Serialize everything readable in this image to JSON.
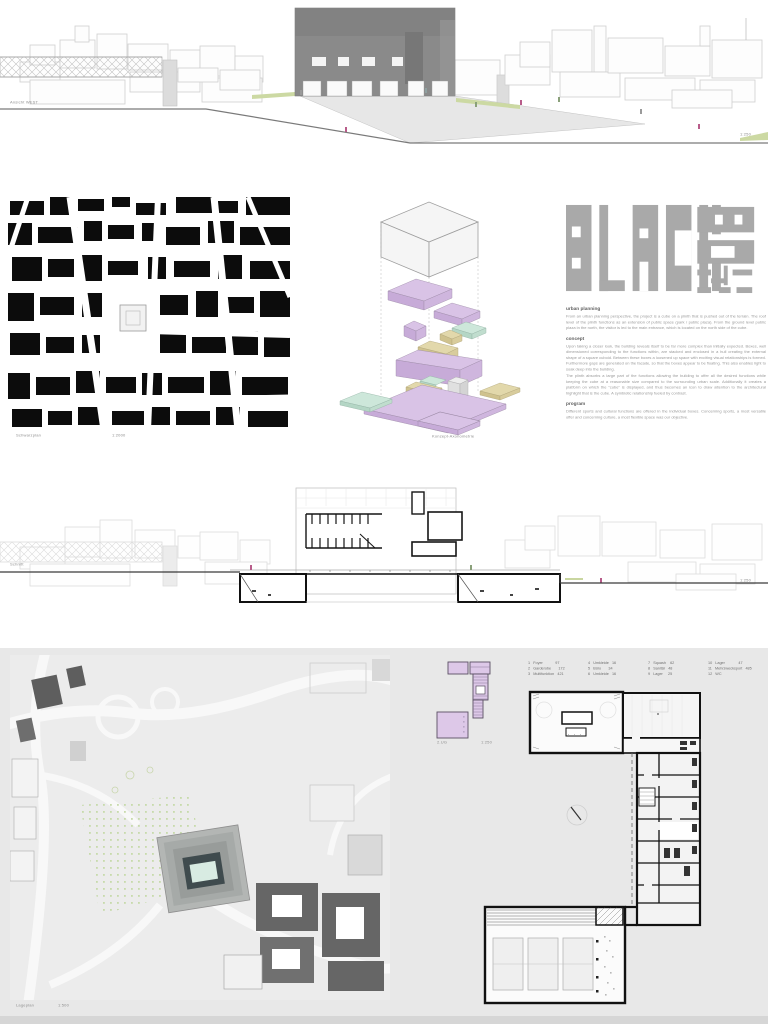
{
  "board": {
    "elevation": {
      "label": "Ansicht WEST",
      "scale": "1:250"
    },
    "schwarzplan": {
      "label": "Schwarzplan",
      "scale": "1:2000"
    },
    "axonometric": {
      "label": "Konzept-Axonometrie"
    },
    "logo": {
      "word": "BLACK"
    },
    "essay": {
      "urban_heading": "urban planning",
      "urban_body": "From an urban planning perspective, the project is a cube on a plinth that is pushed out of the terrain. The roof level of the plinth functions as an extension of public space (park / public plaza). From the ground level public plaza in the north, the visitor is led to the main entrance, which is located on the north side of the cube.",
      "concept_heading": "concept",
      "concept_body_1": "Upon taking a closer look, the building reveals itself to be far more complex than initially expected. Boxes, well dimensioned corresponding to the functions within, are stacked and enclosed in a hull creating the external shape of a square cuboid. Between these boxes a loosened up space with exciting visual relationships is formed. Furthermore gaps are generated on the facade, so that the boxes appear to be floating. This also enables light to soak deep into the building.",
      "concept_body_2": "The plinth absorbs a large part of the functions allowing the building to offer all the desired functions while keeping the cube at a reasonable size compared to the surrounding urban scale. Additionally it creates a platform on which the \"cube\" is displayed, and thus becomes an icon to draw attention to the architectural highlight that is the cube. A symbiotic relationship fueled by contrast.",
      "program_heading": "program",
      "program_body": "Different sports and cultural functions are offered in the individual boxes. Concerning sports, a most versatile offer and concerning culture, a most flexible space was our objective."
    },
    "section": {
      "label": "Schnitt",
      "scale": "1:250"
    },
    "siteplan": {
      "label": "Lageplan",
      "scale": "1:500"
    },
    "floorplans": {
      "basement_label": "2.UG",
      "basement_scale": "1:250",
      "legend": {
        "col1": [
          "1   Foyer            97",
          "2   Garderobe       172",
          "3   Multifunktion   421"
        ],
        "col2": [
          "4   Umkleide   16",
          "5   Büro       34",
          "6   Umkleide   16"
        ],
        "col3": [
          "7   Squash    62",
          "8   Sanitär   48",
          "9   Lager     25"
        ],
        "col4": [
          "10   Lager             47",
          "11   Mehrzwecksport   485",
          "12   WC"
        ]
      }
    },
    "colors": {
      "lavender": "#d9c3e6",
      "tan": "#e2d8ab",
      "teal": "#cde7da",
      "logo_gray": "#a9a9a9",
      "panel_gray": "#e8e8e8",
      "black_map": "#0c0c0c"
    }
  }
}
